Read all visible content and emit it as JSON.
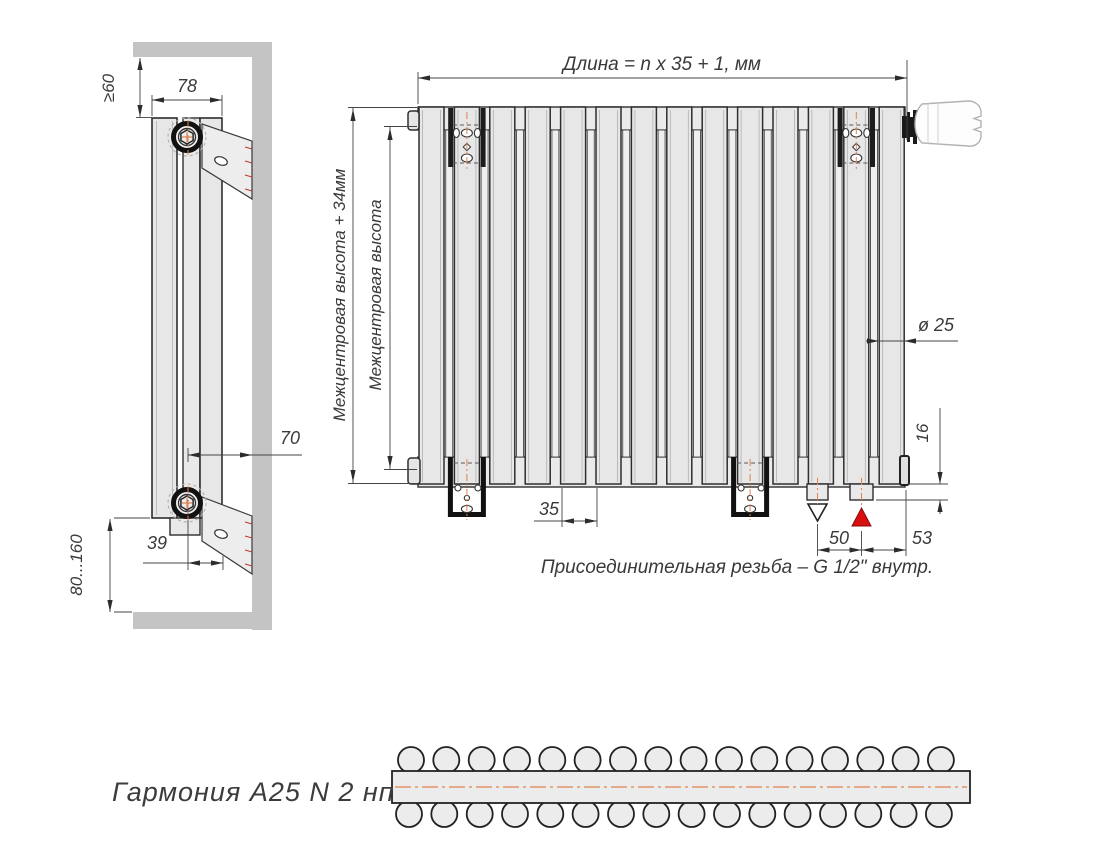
{
  "drawing_title": "Гармония  А25 N 2 нп",
  "front_view": {
    "length_formula": "Длина = n x 35 + 1, мм",
    "height_overall_label": "Межцентровая высота + 34мм",
    "height_centers_label": "Межцентровая высота",
    "tube_diameter_label": "ø 25",
    "tube_pitch_label": "35",
    "connection_spacing_label": "50",
    "connection_edge_label": "53",
    "connection_stub_label": "16",
    "thread_note": "Присоединительная резьба – G 1/2\" внутр.",
    "front_tube_count": 14
  },
  "side_view": {
    "top_clearance_label": "≥60",
    "depth_label": "78",
    "wall_distance_label": "70",
    "bracket_width_label": "39",
    "floor_clearance_label": "80...160"
  },
  "top_view": {
    "rows": 2,
    "tubes_per_row": 16
  },
  "colors": {
    "inlet_marker": "#d90f0f",
    "outlet_marker": "#ffffff",
    "centerline": "#e0824f",
    "wall": "#c4c4c4",
    "tube_fill": "#e7e7e7",
    "line": "#2e2e2e"
  }
}
